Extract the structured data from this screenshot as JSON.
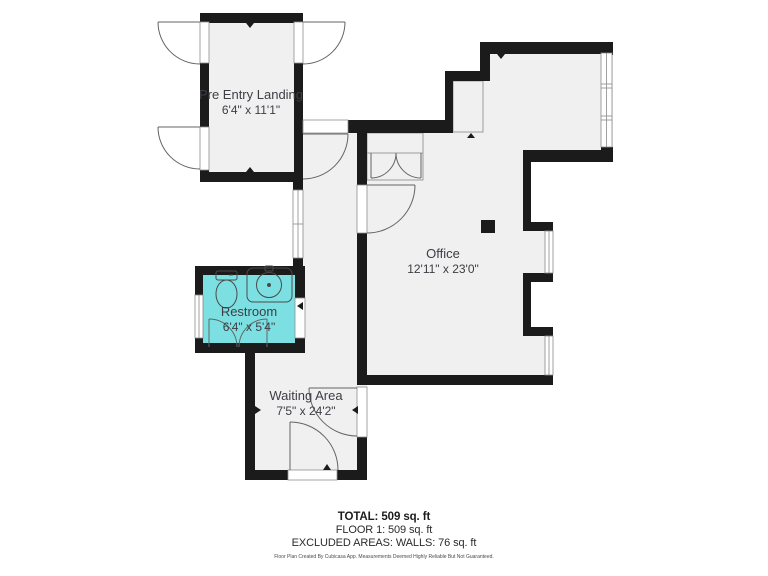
{
  "plan": {
    "rooms": [
      {
        "id": "pre-entry-landing",
        "name": "Pre Entry Landing",
        "dims": "6'4\" x 11'1\""
      },
      {
        "id": "office",
        "name": "Office",
        "dims": "12'11\" x 23'0\""
      },
      {
        "id": "restroom",
        "name": "Restroom",
        "dims": "6'4\" x 5'4\""
      },
      {
        "id": "waiting-area",
        "name": "Waiting Area",
        "dims": "7'5\" x 24'2\""
      }
    ],
    "colors": {
      "wall": "#1b1b1b",
      "floor": "#f0f0f0",
      "restroom_fill": "#7ce0e2"
    }
  },
  "summary": {
    "total": "TOTAL: 509 sq. ft",
    "floor": "FLOOR 1: 509 sq. ft",
    "excluded": "EXCLUDED AREAS: WALLS: 76 sq. ft",
    "disclaimer": "Floor Plan Created By Cubicasa App. Measurements Deemed Highly Reliable But Not Guaranteed."
  }
}
